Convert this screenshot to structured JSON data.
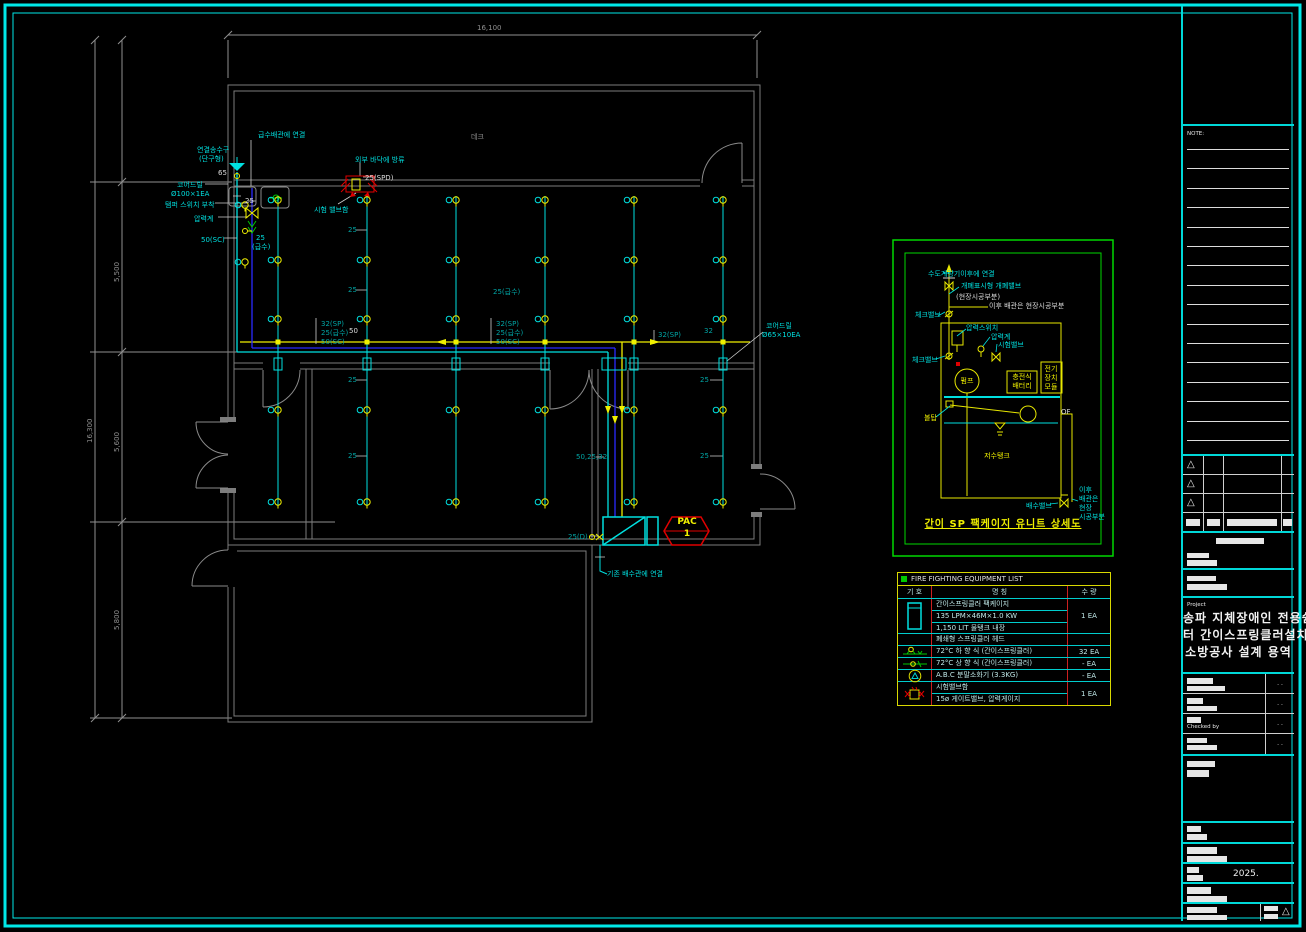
{
  "sheet": {
    "background": "#000000",
    "border_color": "#00e8e8"
  },
  "plan": {
    "branch_x": [
      278,
      367,
      456,
      545,
      634,
      723
    ],
    "head_rows": [
      200,
      260,
      319,
      410,
      502
    ],
    "extra_heads": [
      [
        245,
        205
      ],
      [
        245,
        262
      ]
    ],
    "labels": [
      {
        "t": "급수배관에 연결",
        "x": 258,
        "y": 131,
        "c": "cyan"
      },
      {
        "t": "연결송수구",
        "x": 197,
        "y": 146,
        "c": "cyan"
      },
      {
        "t": "(단구형)",
        "x": 199,
        "y": 155,
        "c": "cyan"
      },
      {
        "t": "65",
        "x": 218,
        "y": 169,
        "c": "white"
      },
      {
        "t": "코어드릴",
        "x": 177,
        "y": 181,
        "c": "cyan"
      },
      {
        "t": "Ø100×1EA",
        "x": 171,
        "y": 190,
        "c": "cyan"
      },
      {
        "t": "탬퍼 스위치 부착",
        "x": 165,
        "y": 201,
        "c": "cyan"
      },
      {
        "t": "압력계",
        "x": 194,
        "y": 215,
        "c": "cyan"
      },
      {
        "t": "50(SC)",
        "x": 201,
        "y": 236,
        "c": "cyan"
      },
      {
        "t": "25",
        "x": 245,
        "y": 197,
        "c": "white"
      },
      {
        "t": "25",
        "x": 256,
        "y": 234,
        "c": "cyan"
      },
      {
        "t": "(급수)",
        "x": 252,
        "y": 243,
        "c": "cyan"
      },
      {
        "t": "외부 바닥에 방류",
        "x": 355,
        "y": 156,
        "c": "cyan"
      },
      {
        "t": "25(SPD)",
        "x": 365,
        "y": 174,
        "c": "white"
      },
      {
        "t": "시험 밸브함",
        "x": 314,
        "y": 206,
        "c": "cyan"
      },
      {
        "t": "데크",
        "x": 471,
        "y": 133,
        "c": "gray"
      },
      {
        "t": "32(SP)",
        "x": 321,
        "y": 320,
        "c": "teal"
      },
      {
        "t": "25(급수)",
        "x": 321,
        "y": 329,
        "c": "teal"
      },
      {
        "t": "50(SC)",
        "x": 321,
        "y": 338,
        "c": "teal"
      },
      {
        "t": "25(급수)",
        "x": 493,
        "y": 288,
        "c": "teal"
      },
      {
        "t": "32(SP)",
        "x": 496,
        "y": 320,
        "c": "teal"
      },
      {
        "t": "25(급수)",
        "x": 496,
        "y": 329,
        "c": "teal"
      },
      {
        "t": "50(SC)",
        "x": 496,
        "y": 338,
        "c": "teal"
      },
      {
        "t": "32(SP)",
        "x": 658,
        "y": 331,
        "c": "teal"
      },
      {
        "t": "32",
        "x": 704,
        "y": 327,
        "c": "teal"
      },
      {
        "t": "코어드릴",
        "x": 766,
        "y": 322,
        "c": "cyan"
      },
      {
        "t": "Ø65×10EA",
        "x": 762,
        "y": 331,
        "c": "cyan"
      },
      {
        "t": "50",
        "x": 349,
        "y": 327,
        "c": "white"
      },
      {
        "t": "25",
        "x": 348,
        "y": 226,
        "c": "teal"
      },
      {
        "t": "25",
        "x": 348,
        "y": 286,
        "c": "teal"
      },
      {
        "t": "25",
        "x": 348,
        "y": 376,
        "c": "teal"
      },
      {
        "t": "25",
        "x": 348,
        "y": 452,
        "c": "teal"
      },
      {
        "t": "25",
        "x": 700,
        "y": 376,
        "c": "teal"
      },
      {
        "t": "25",
        "x": 700,
        "y": 452,
        "c": "teal"
      },
      {
        "t": "50,25,32",
        "x": 576,
        "y": 453,
        "c": "teal"
      },
      {
        "t": "25(D)",
        "x": 568,
        "y": 533,
        "c": "teal"
      },
      {
        "t": "기존 배수관에 연결",
        "x": 607,
        "y": 570,
        "c": "cyan"
      },
      {
        "t": "PAC",
        "x": 687,
        "y": 518,
        "c": "yellow",
        "a": "middle",
        "s": 9
      },
      {
        "t": "1",
        "x": 687,
        "y": 530,
        "c": "yellow",
        "a": "middle",
        "s": 9
      },
      {
        "t": "16,100",
        "x": 477,
        "y": 24,
        "c": "gray"
      },
      {
        "t": "16,300",
        "x": 86,
        "y": 443,
        "c": "gray",
        "rot": true
      },
      {
        "t": "5,500",
        "x": 113,
        "y": 282,
        "c": "gray",
        "rot": true
      },
      {
        "t": "5,600",
        "x": 113,
        "y": 452,
        "c": "gray",
        "rot": true
      },
      {
        "t": "5,800",
        "x": 113,
        "y": 630,
        "c": "gray",
        "rot": true
      }
    ]
  },
  "detail": {
    "title": "간이 SP 팩케이지 유니트 상세도",
    "labels": [
      {
        "t": "수도계량기이후에 연결",
        "x": 928,
        "y": 270,
        "c": "cyan"
      },
      {
        "t": "개폐표시형 개폐밸브",
        "x": 961,
        "y": 282,
        "c": "cyan"
      },
      {
        "t": "(현장시공부분)",
        "x": 956,
        "y": 293,
        "c": "white"
      },
      {
        "t": "이후 배관은 현장시공부분",
        "x": 989,
        "y": 302,
        "c": "white"
      },
      {
        "t": "체크밸브",
        "x": 915,
        "y": 311,
        "c": "cyan"
      },
      {
        "t": "압력스위치",
        "x": 966,
        "y": 324,
        "c": "cyan"
      },
      {
        "t": "압력계",
        "x": 991,
        "y": 333,
        "c": "cyan"
      },
      {
        "t": "시험밸브",
        "x": 998,
        "y": 341,
        "c": "cyan"
      },
      {
        "t": "체크밸브",
        "x": 912,
        "y": 356,
        "c": "cyan"
      },
      {
        "t": "펌프",
        "x": 967,
        "y": 377,
        "c": "yellow",
        "a": "middle"
      },
      {
        "t": "충전식",
        "x": 1022,
        "y": 373,
        "c": "yellow",
        "a": "middle"
      },
      {
        "t": "배터리",
        "x": 1022,
        "y": 382,
        "c": "yellow",
        "a": "middle"
      },
      {
        "t": "전기",
        "x": 1051,
        "y": 365,
        "c": "yellow",
        "a": "middle"
      },
      {
        "t": "장치",
        "x": 1051,
        "y": 374,
        "c": "yellow",
        "a": "middle"
      },
      {
        "t": "모듈",
        "x": 1051,
        "y": 383,
        "c": "yellow",
        "a": "middle"
      },
      {
        "t": "볼탑",
        "x": 924,
        "y": 414,
        "c": "yellow"
      },
      {
        "t": "OF",
        "x": 1061,
        "y": 408,
        "c": "white"
      },
      {
        "t": "저수탱크",
        "x": 997,
        "y": 452,
        "c": "yellow",
        "a": "middle"
      },
      {
        "t": "배수밸브",
        "x": 1026,
        "y": 502,
        "c": "cyan"
      },
      {
        "t": "이후",
        "x": 1079,
        "y": 486,
        "c": "cyan"
      },
      {
        "t": "배관은",
        "x": 1079,
        "y": 495,
        "c": "cyan"
      },
      {
        "t": "현장",
        "x": 1079,
        "y": 504,
        "c": "cyan"
      },
      {
        "t": "시공부분",
        "x": 1079,
        "y": 513,
        "c": "cyan"
      }
    ]
  },
  "equipment_table": {
    "title": "FIRE FIGHTING EQUIPMENT LIST",
    "col_symbol": "기  호",
    "col_name": "명        칭",
    "col_qty": "수  량",
    "rows": [
      {
        "icon": "package",
        "names": [
          "간이스프링클러 팩케이지",
          "135 LPM×46M×1.0 KW",
          "1,150 LIT 물탱크 내장"
        ],
        "qty": "1 EA"
      },
      {
        "icon": "",
        "names": [
          "폐쇄형 스프링클러 헤드"
        ],
        "qty": ""
      },
      {
        "icon": "pendent",
        "names": [
          "72°C 하 향 식 (간이스프링클러)"
        ],
        "qty": "32 EA"
      },
      {
        "icon": "upright",
        "names": [
          "72°C 상 향 식 (간이스프링클러)"
        ],
        "qty": "- EA"
      },
      {
        "icon": "extinguisher",
        "names": [
          "A.B.C 분말소화기 (3.3KG)"
        ],
        "qty": "- EA"
      },
      {
        "icon": "testvalve",
        "names": [
          "시험밸브함",
          "15ø 게이트밸브, 압력게이지"
        ],
        "qty": "1 EA"
      }
    ]
  },
  "title_block": {
    "note_label": "NOTE:",
    "project_label": "Project",
    "project_title_lines": [
      "송파 지체장애인 전용쉼",
      "터 간이스프링클러설치",
      "소방공사 설계 용역"
    ],
    "checked_by_label": "Checked by",
    "date_text": "2025.",
    "dots": ". .",
    "revision_triangle": "△"
  }
}
